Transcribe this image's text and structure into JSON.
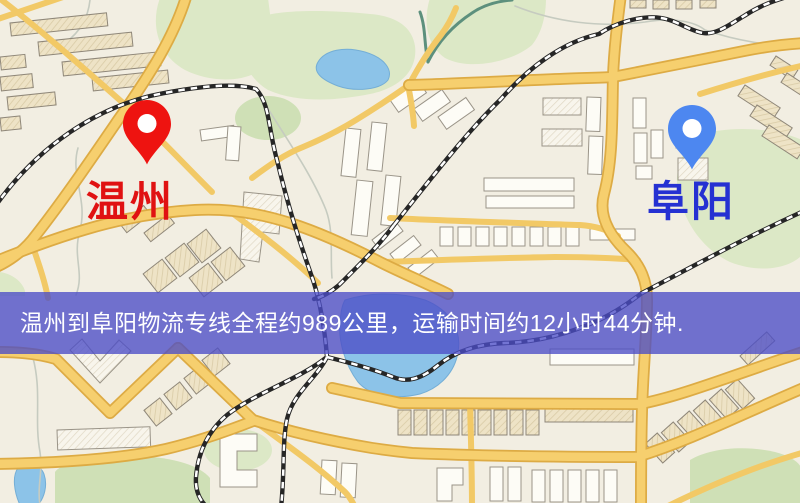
{
  "banner": {
    "text": "温州到阜阳物流专线全程约989公里，运输时间约12小时44分钟.",
    "background": "#4b4dc6",
    "text_color": "#ffffff"
  },
  "origin": {
    "city": "温州",
    "label_color": "#e01212",
    "pin_color": "#ee1310"
  },
  "destination": {
    "city": "阜阳",
    "label_color": "#2531d2",
    "pin_color": "#4d87f0"
  },
  "map_palette": {
    "background": "#f2eee2",
    "road": "#f6cf6e",
    "road_edge": "#ddab44",
    "road_minor": "#f2c966",
    "water": "#8cc3e8",
    "water_edge": "#74aed6",
    "park": "#dce8c6",
    "park_dark": "#cfe0b6",
    "railway": "#262626",
    "railway_dash": "#ffffff",
    "building": "#eee3c6",
    "building_white": "#fdfcf6",
    "building_outline": "#8f8779",
    "stream": "#c6cbc0",
    "river": "#5d907d"
  }
}
